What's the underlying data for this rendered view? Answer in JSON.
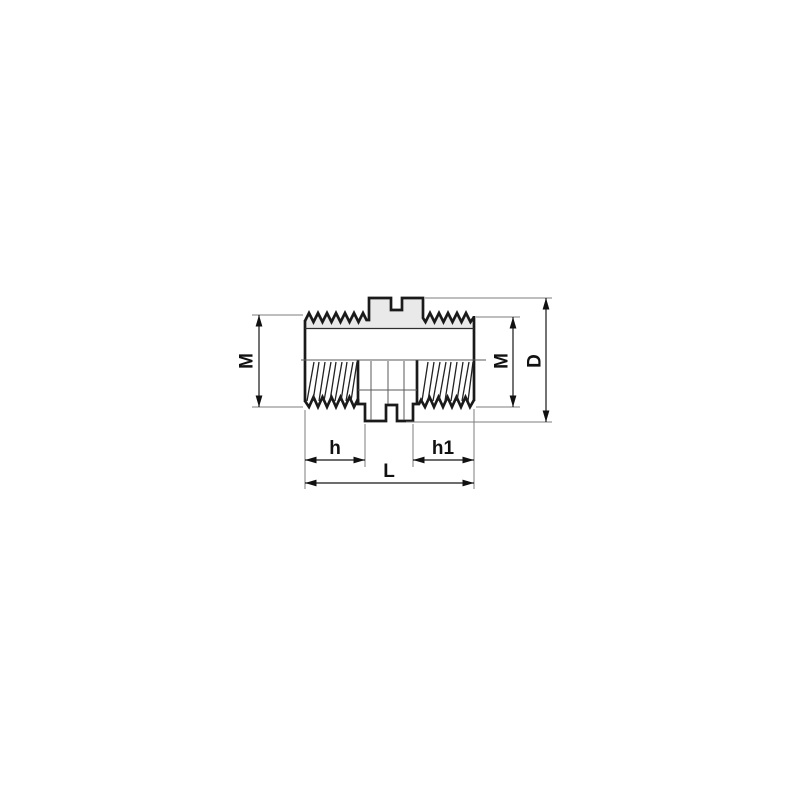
{
  "drawing": {
    "colors": {
      "background": "#ffffff",
      "outline": "#1a1a1a",
      "thread_band_fill": "#e9e9e9",
      "dimension_line": "#161616",
      "extension_line": "#7d7d7d"
    },
    "labels": {
      "m_left": "M",
      "m_right": "M",
      "d": "D",
      "h": "h",
      "h1": "h1",
      "l": "L"
    }
  }
}
